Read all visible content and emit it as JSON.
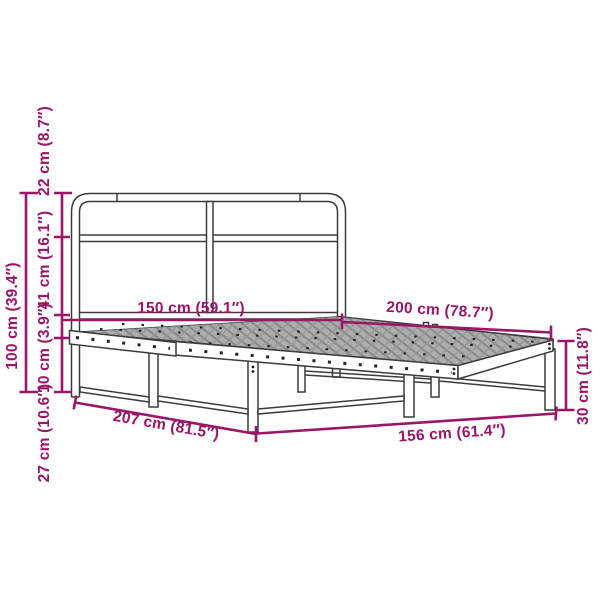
{
  "figure": {
    "kind": "product dimension diagram",
    "subject": "metal bed frame with headboard, perforated side rails and mesh slat surface"
  },
  "colors": {
    "dimension": "#9C1566",
    "line_art": "#3C3C3C",
    "mesh": "#B3B3B3"
  },
  "dimensions": {
    "mattress_width": "150 cm (59.1″)",
    "mattress_length": "200 cm (78.7″)",
    "total_height": "100 cm (39.4″)",
    "headboard_top_section": "22 cm (8.7″)",
    "headboard_mid_section": "41 cm (16.1″)",
    "frame_rail_height": "10 cm (3.9″)",
    "under_bed_clearance": "27 cm (10.6″)",
    "foot_end_height": "30 cm (11.8″)",
    "total_length": "207 cm (81.5″)",
    "total_width": "156 cm (61.4″)"
  }
}
